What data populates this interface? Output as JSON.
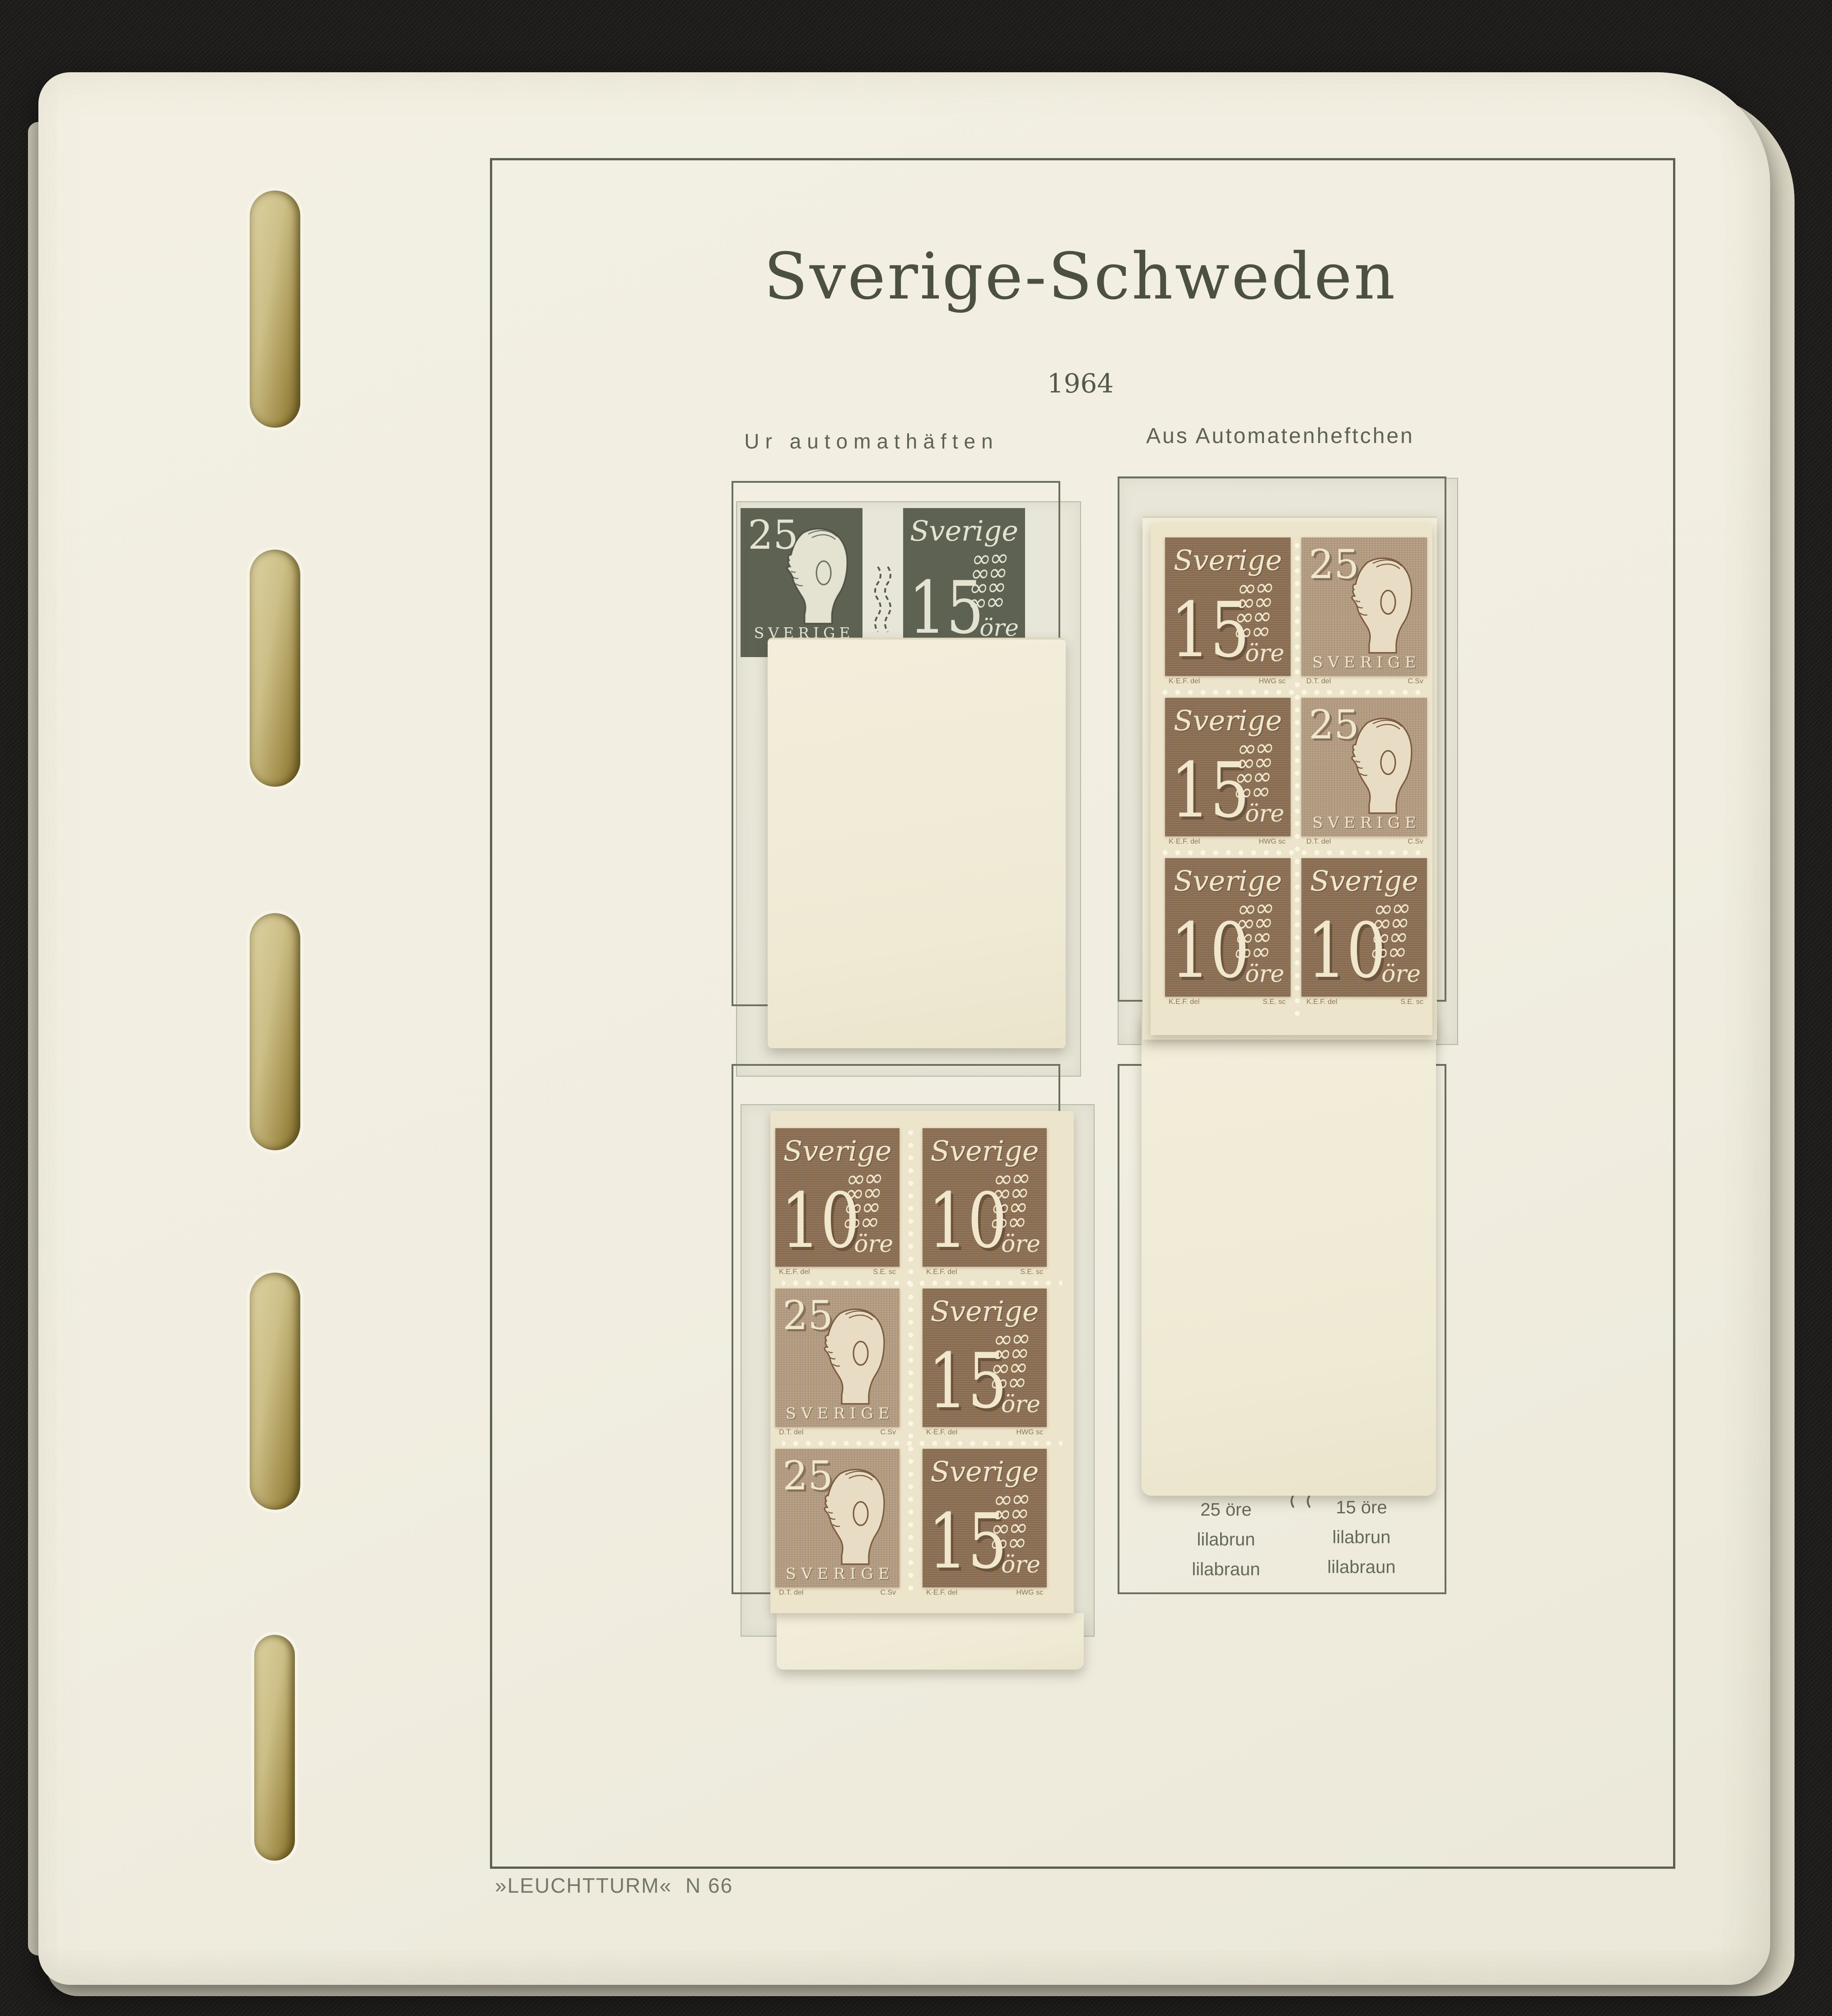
{
  "album_page": {
    "title": "Sverige-Schweden",
    "year": "1964",
    "left_column_header": "Ur automathäften",
    "right_column_header": "Aus Automatenheftchen",
    "publisher_mark": "»LEUCHTTURM«",
    "page_number": "N 66"
  },
  "stamp_types": {
    "num15": {
      "kind": "numeral",
      "script": "Sverige",
      "value": "15",
      "unit": "öre",
      "designer": "K·E.F. del",
      "engraver": "HWG sc"
    },
    "num10": {
      "kind": "numeral",
      "script": "Sverige",
      "value": "10",
      "unit": "öre",
      "designer": "K.E.F. del",
      "engraver": "S.E. sc"
    },
    "king25": {
      "kind": "king",
      "value": "25",
      "country": "SVERIGE",
      "designer": "D.T. del",
      "engraver": "C.Sv"
    },
    "num15_dark": {
      "kind": "numeral",
      "script": "Sverige",
      "value": "15",
      "unit": "öre"
    },
    "king25_dark": {
      "kind": "king",
      "value": "25",
      "country": "SVERIGE"
    }
  },
  "illustration_pair": [
    "king25_dark",
    "num15_dark"
  ],
  "booklet_panes": {
    "left": {
      "rows": [
        [
          "num10",
          "num10"
        ],
        [
          "king25",
          "num15"
        ],
        [
          "king25",
          "num15"
        ]
      ]
    },
    "right": {
      "rows": [
        [
          "num15",
          "king25"
        ],
        [
          "num15",
          "king25"
        ],
        [
          "num10",
          "num10"
        ]
      ]
    }
  },
  "color_captions": {
    "left": {
      "value": "25 öre",
      "swedish": "lilabrun",
      "german": "lilabraun"
    },
    "right": {
      "value": "15 öre",
      "swedish": "lilabrun",
      "german": "lilabraun"
    }
  },
  "colors": {
    "background_black": "#1b1a18",
    "page_cream": "#f1eee1",
    "cover_cream": "#efead4",
    "pane_cream": "#ece4cb",
    "stamp_brown": "#8a6c4e",
    "king_stamp_tan": "#b49b7e",
    "printed_dark_green": "#575c4e",
    "ink_grey_green": "#5b604f",
    "binder_hole_olive": "#8d7a37"
  }
}
